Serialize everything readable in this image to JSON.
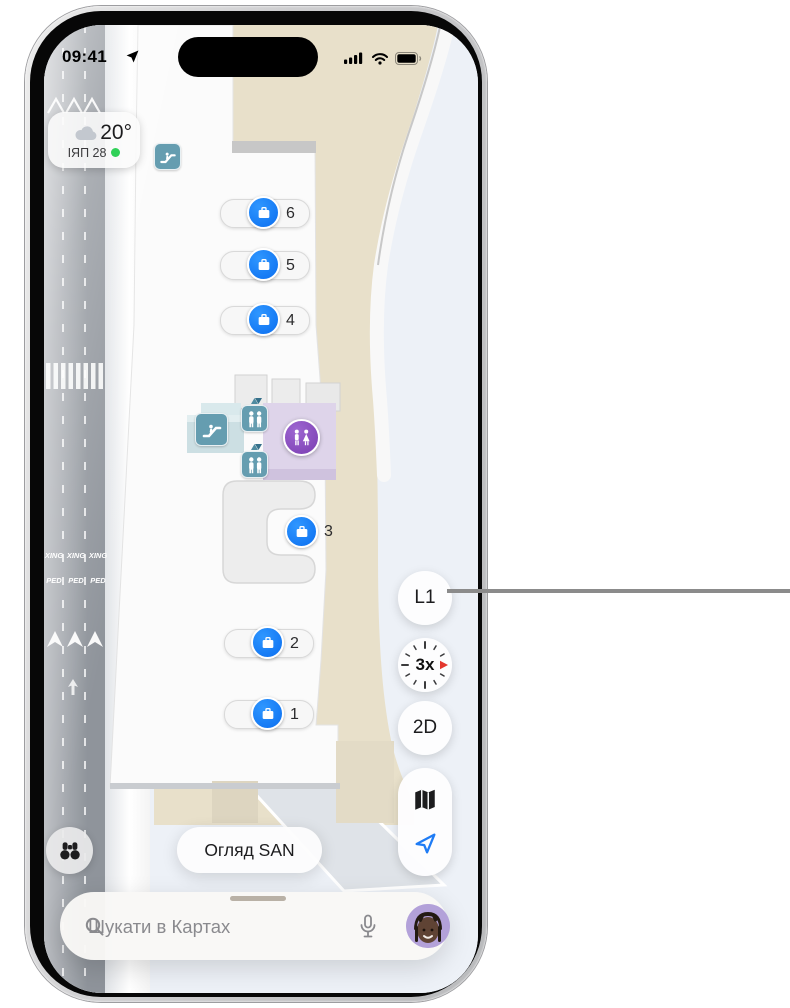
{
  "status_bar": {
    "time": "09:41"
  },
  "weather": {
    "temperature": "20°",
    "air_quality": "ІЯП 28"
  },
  "map": {
    "baggage_claims": [
      {
        "number": "6"
      },
      {
        "number": "5"
      },
      {
        "number": "4"
      },
      {
        "number": "3"
      },
      {
        "number": "2"
      },
      {
        "number": "1"
      }
    ],
    "road_markings": {
      "xing": "XING",
      "ped": "PED"
    }
  },
  "controls": {
    "level": "L1",
    "compass_scale": "3x",
    "view_mode": "2D"
  },
  "buttons": {
    "overview": "Огляд SAN"
  },
  "search": {
    "placeholder": "Шукати в Картах"
  },
  "colors": {
    "marker_blue": "#0b6ef0",
    "accent_blue": "#1f7cf5",
    "teal": "#659db0",
    "purple": "#7a3db1",
    "green_dot": "#30d158",
    "beige": "#e8e0ca",
    "pale_blue": "#edf1f7",
    "road_gray": "#8f949b"
  }
}
